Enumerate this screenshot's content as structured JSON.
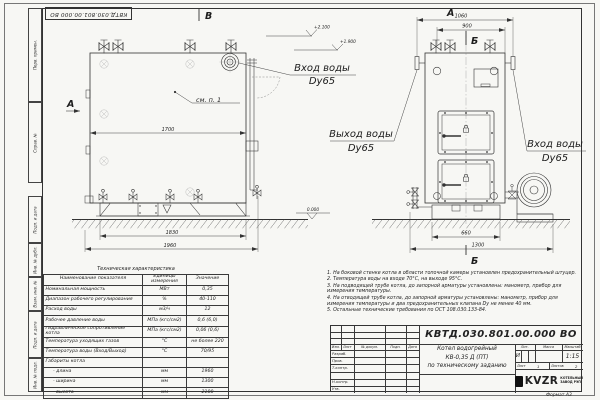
{
  "sheet": {
    "top_stamp": "КВТД.030.801.00.000  ВО",
    "format_label": "Формат  А3"
  },
  "margin": {
    "perv_primen": "Перв. примен.",
    "sprav_no": "Справ. №",
    "podp_data_1": "Подп. и дата",
    "inv_dubl": "Инв. № дубл.",
    "vzam_inv": "Взам. инв. №",
    "podp_data_2": "Подп. и дата",
    "inv_podl": "Инв. № подл."
  },
  "views": {
    "side": {
      "label": "В",
      "arrow_label": "А",
      "callout": "см. п. 1",
      "dim_width": "1700",
      "dim_base": "1830",
      "dim_total": "1960"
    },
    "front": {
      "label": "А",
      "section_label": "Б",
      "dim_flanges": "1060",
      "dim_body": "900",
      "dim_base": "660",
      "dim_total": "1300"
    }
  },
  "marks": {
    "elev_top": "+2.100",
    "elev_mid": "+1.900",
    "elev_zero": "0.000"
  },
  "labels": {
    "inlet_side": {
      "line1": "Вход воды",
      "line2": "Dy65"
    },
    "outlet": {
      "line1": "Выход воды",
      "line2": "Dy65"
    },
    "inlet_front": {
      "line1": "Вход воды",
      "line2": "Dy65"
    }
  },
  "spec_table": {
    "title": "Техническая характеристика",
    "headers": [
      "Наименование показателя",
      "Единицы измерения",
      "Значение"
    ],
    "rows": [
      [
        "Номинальная мощность",
        "МВт",
        "0,35"
      ],
      [
        "Диапазон рабочего регулирования",
        "%",
        "40-110"
      ],
      [
        "Расход воды",
        "м3/ч",
        "12"
      ],
      [
        "Рабочее давление воды",
        "МПа (кгс/см2)",
        "0,6 (6,0)"
      ],
      [
        "Гидравлическое сопротивление котла",
        "МПа (кгс/см2)",
        "0,06 (0,6)"
      ],
      [
        "Температура уходящих газов",
        "°С",
        "не более 220"
      ],
      [
        "Температура воды (Вход/Выход)",
        "°С",
        "70/95"
      ],
      [
        "Габариты котла",
        "",
        ""
      ],
      [
        "- длина",
        "мм",
        "1960"
      ],
      [
        "- ширина",
        "мм",
        "1300"
      ],
      [
        "- высота",
        "мм",
        "2100"
      ]
    ]
  },
  "notes": {
    "items": [
      "1. На боковой стенке котла в области топочной камеры установлен предохранительный штуцер.",
      "2. Температура воды на входе 70°С, на выходе 95°С.",
      "3. На подводящей трубе котла, до запорной арматуры установлены: манометр, прибор для измерения температуры.",
      "4. На отводящей трубе котла, до запорной арматуры установлены: манометр, прибор для измерения температуры и два предохранительных клапана Dу не менее 40 мм.",
      "5. Остальные технические требования по ОСТ 108.030.133-84."
    ]
  },
  "title_block": {
    "designation": "КВТД.030.801.00.000  ВО",
    "product_name_1": "Котел водогрейный",
    "product_name_2": "КВ-0,35 Д (ПТ)",
    "product_name_3": "по техническому заданию",
    "header_cols": [
      "Изм.",
      "Лист",
      "№ докум.",
      "Подп.",
      "Дата"
    ],
    "row_labels": [
      "Разраб.",
      "Пров.",
      "Т.контр.",
      "Н.контр.",
      "Утв."
    ],
    "lit_header": "Лит.",
    "mass_header": "Масса",
    "scale_header": "Масштаб",
    "lit_value": "И",
    "scale_value": "1:15",
    "sheet_label": "Лист",
    "sheet_value": "1",
    "sheets_label": "Листов",
    "sheets_value": "2",
    "logo_text": "KVZR",
    "logo_caption_1": "КОТЕЛЬНЫЙ",
    "logo_caption_2": "ЗАВОД РЭП"
  }
}
